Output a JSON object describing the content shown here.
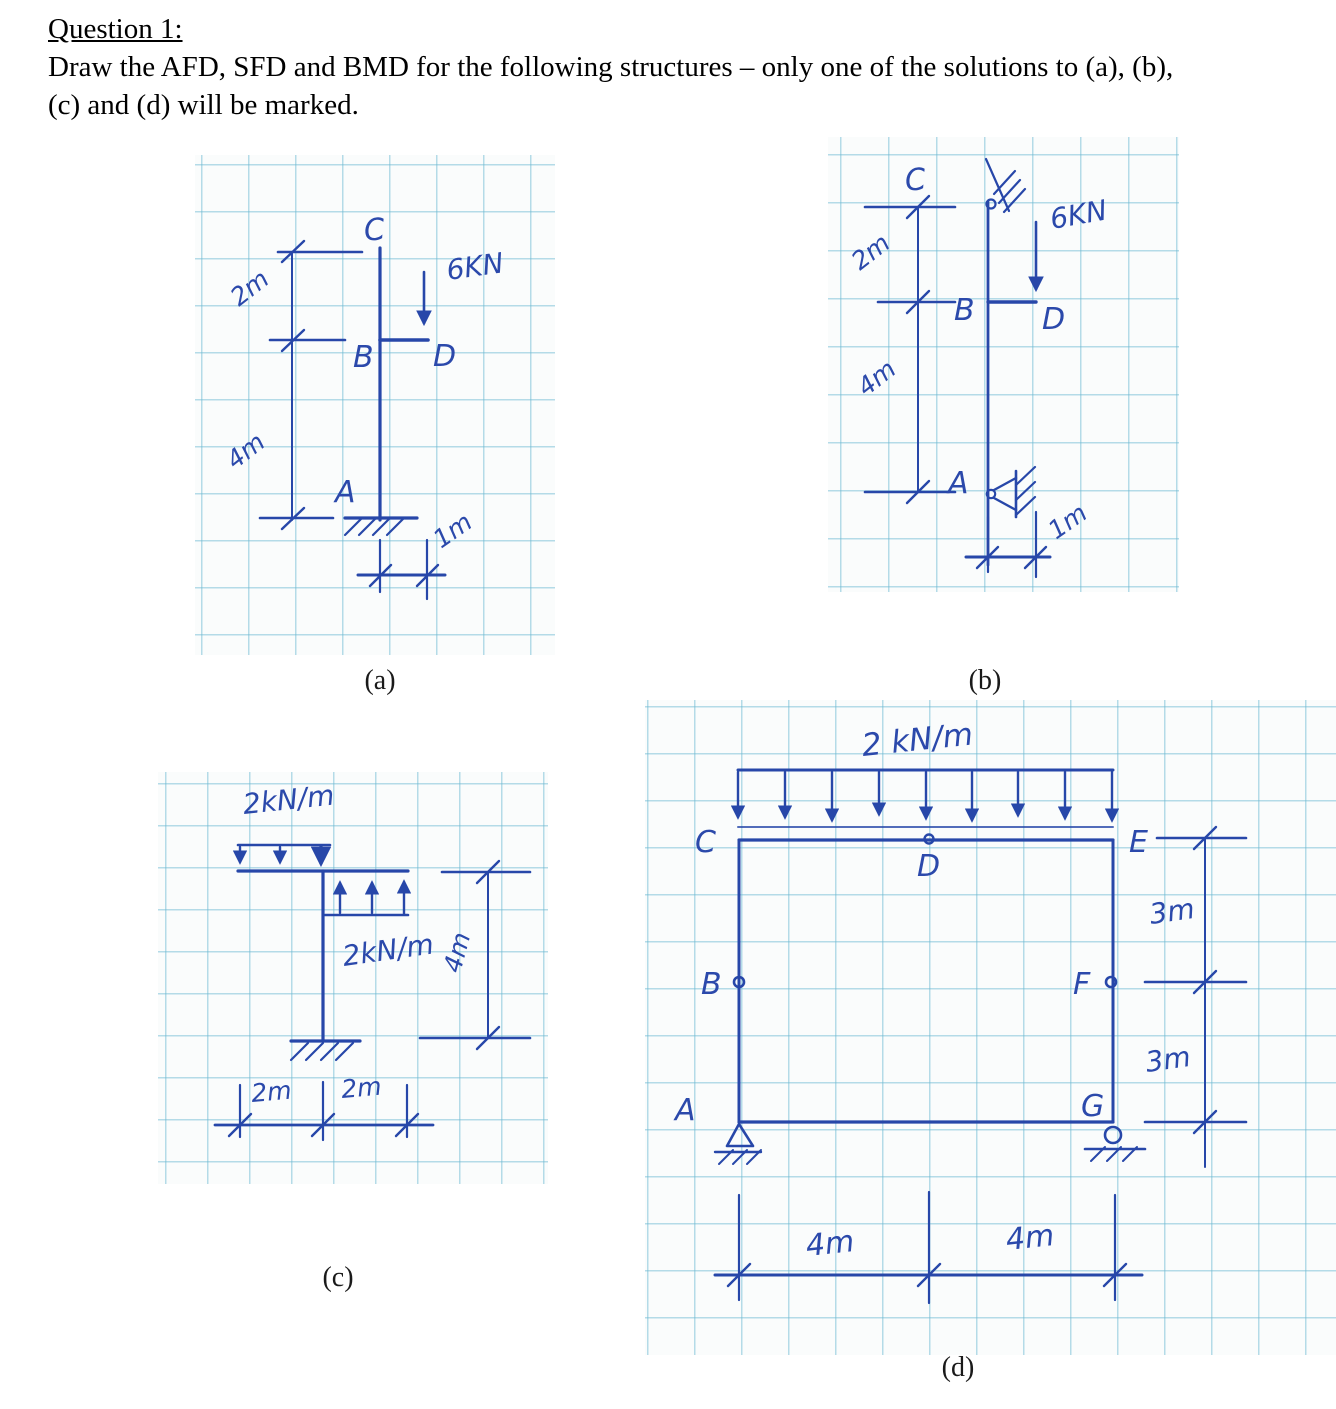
{
  "page": {
    "title": "Question 1:",
    "body_line1": "Draw the AFD, SFD and BMD for the following structures – only one of the solutions to (a), (b),",
    "body_line2": "(c) and (d) will be marked."
  },
  "figures": {
    "a": {
      "caption": "(a)",
      "nodes": {
        "A": "A",
        "B": "B",
        "C": "C",
        "D": "D"
      },
      "point_load": "6KN",
      "dims": {
        "top": "2m",
        "bottom": "4m",
        "offset": "1m"
      }
    },
    "b": {
      "caption": "(b)",
      "nodes": {
        "A": "A",
        "B": "B",
        "C": "C",
        "D": "D"
      },
      "point_load": "6KN",
      "dims": {
        "top": "2m",
        "bottom": "4m",
        "offset": "1m"
      }
    },
    "c": {
      "caption": "(c)",
      "udl_left": "2kN/m",
      "udl_right": "2kN/m",
      "dims": {
        "left_span": "2m",
        "right_span": "2m",
        "height": "4m"
      }
    },
    "d": {
      "caption": "(d)",
      "udl": "2 kN/m",
      "nodes": {
        "A": "A",
        "B": "B",
        "C": "C",
        "D": "D",
        "E": "E",
        "F": "F",
        "G": "G"
      },
      "dims": {
        "span_left": "4m",
        "span_right": "4m",
        "height_top": "3m",
        "height_bottom": "3m"
      }
    }
  }
}
